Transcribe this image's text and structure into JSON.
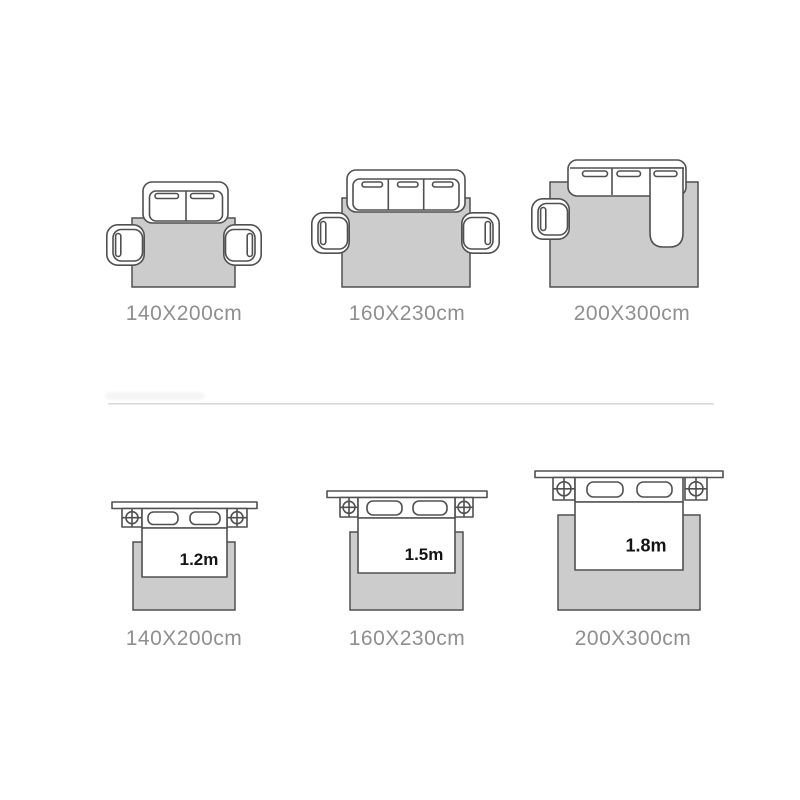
{
  "colors": {
    "outline": "#505050",
    "rug_fill": "#cccccc",
    "label_text": "#8f8f8f",
    "bed_size_text": "#141414",
    "divider": "#c9c9c9"
  },
  "sofa_row": {
    "items": [
      {
        "label": "140X200cm"
      },
      {
        "label": "160X230cm"
      },
      {
        "label": "200X300cm"
      }
    ]
  },
  "bed_row": {
    "items": [
      {
        "label": "140X200cm",
        "bed_width": "1.2m"
      },
      {
        "label": "160X230cm",
        "bed_width": "1.5m"
      },
      {
        "label": "200X300cm",
        "bed_width": "1.8m"
      }
    ]
  }
}
